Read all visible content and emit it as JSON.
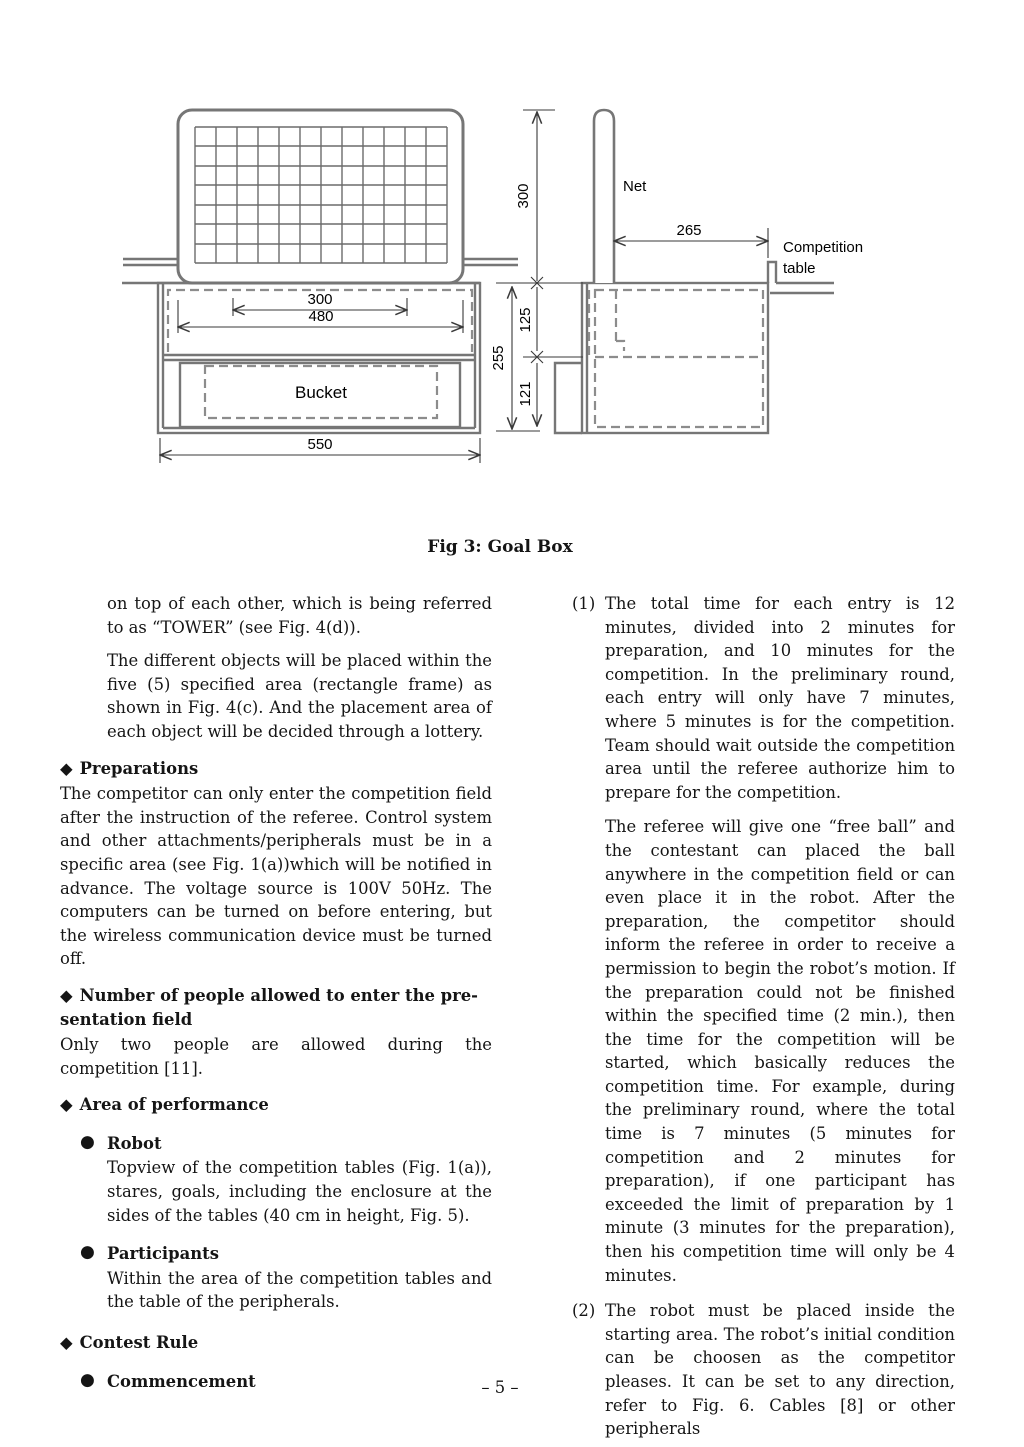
{
  "figure": {
    "caption": "Fig 3:  Goal Box",
    "labels": {
      "net": "Net",
      "bucket": "Bucket",
      "competition_table_1": "Competition",
      "competition_table_2": "table"
    },
    "dims": {
      "front_inner_width": "300",
      "front_frame_width": "480",
      "front_total_width": "550",
      "net_height": "300",
      "box_total_height": "255",
      "box_upper_height": "125",
      "box_lower_height": "121",
      "side_depth": "265"
    }
  },
  "left_column": {
    "marker_diamond": "◆",
    "marker_bullet": "●",
    "intro_para1": "on top of each other, which is being referred to as “TOWER” (see Fig. 4(d)).",
    "intro_para2": "The different objects will be placed within the five (5) specified area (rectangle frame) as shown in Fig. 4(c). And the placement area of each object will be decided through a lottery.",
    "prep_heading": "Preparations",
    "prep_body": "The competitor can only enter the competition field after the instruction of the referee.  Control system and other attachments/peripherals must be in a specific area (see Fig. 1(a))which will be notified in advance.  The voltage source is 100V 50Hz.  The computers can be turned on before entering, but the wireless communication device must be turned off.",
    "people_heading_line1": "Number of people allowed to enter the pre-",
    "people_heading_line2": "sentation field",
    "people_body": "Only two people are allowed during the competition [11].",
    "area_heading": "Area of performance",
    "robot_heading": "Robot",
    "robot_body": "Topview of the competition tables (Fig. 1(a)), stares, goals, including the enclosure at the sides of the tables (40 cm in height, Fig. 5).",
    "participants_heading": "Participants",
    "participants_body": "Within the area of the competition tables and the table of the peripherals.",
    "contest_heading": "Contest Rule",
    "commencement_heading": "Commencement"
  },
  "right_column": {
    "item1_number": "(1)",
    "item1_para1": "The total time for each entry is 12 minutes, divided into 2 minutes for preparation, and 10 minutes for the competition. In the preliminary round, each entry will only have 7 minutes, where 5 minutes is for the competition.  Team should wait outside the competition area until the referee authorize him to prepare for the competition.",
    "item1_para2": "The referee will give one “free ball” and the contestant can placed the ball anywhere in the competition field or can even place it in the robot.  After the preparation, the competitor should inform the referee in order to receive a permission to begin the robot’s motion.  If the preparation could not be finished within the specified time (2 min.), then the time for the competition will be started, which basically reduces the competition time. For example, during the preliminary round, where the total time is 7 minutes (5 minutes for competition and 2 minutes for preparation), if one participant has exceeded the limit of preparation by 1 minute (3 minutes for the preparation), then his competition time will only be 4 minutes.",
    "item2_number": "(2)",
    "item2_para": "The robot must be placed inside the starting area.  The robot’s initial condition can be choosen as the competitor pleases. It can be set to any direction, refer to Fig. 6.  Cables [8] or other peripherals"
  },
  "page": {
    "number": "– 5 –"
  }
}
